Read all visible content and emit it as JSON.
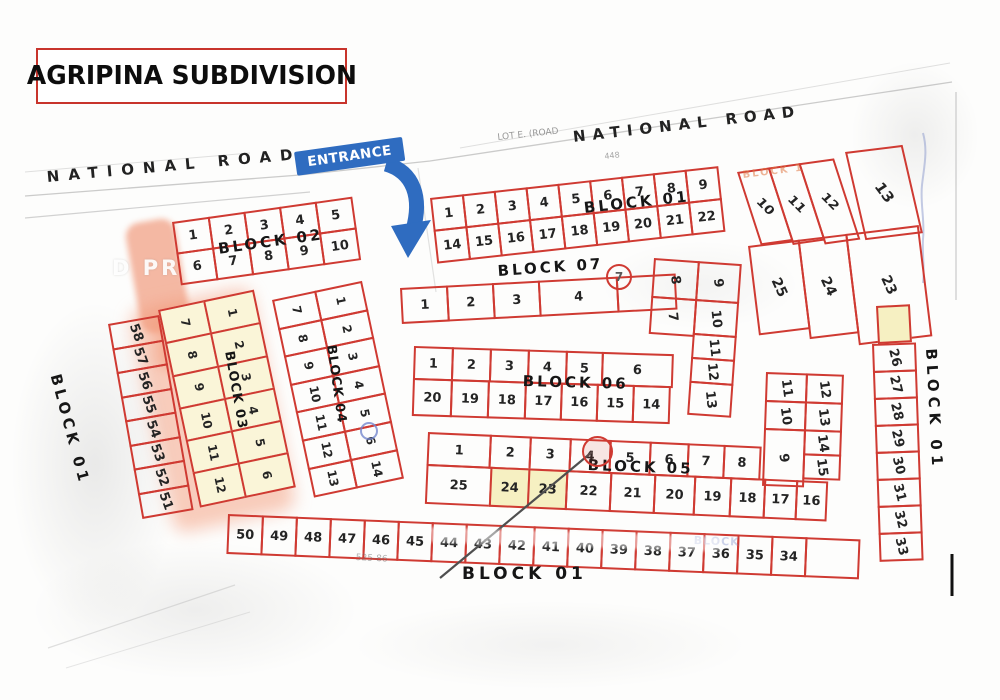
{
  "title": "AGRIPINA SUBDIVISION",
  "roads": {
    "left_label": "NATIONAL ROAD",
    "right_label": "NATIONAL ROAD"
  },
  "entrance": {
    "label": "ENTRANCE"
  },
  "colors": {
    "lot_border_red": "#cf3a32",
    "entrance_blue": "#2f6cc0",
    "highlight_yellow": "#f6f0c2",
    "block03_fill": "#faf5d8",
    "highlight_salmon": "#f2a286"
  },
  "labels": {
    "block01_top": "BLOCK 01",
    "block02": "BLOCK 02",
    "block03": "BLOCK 03",
    "block04": "BLOCK 04",
    "block05": "BLOCK 05",
    "block06": "BLOCK 06",
    "block07": "BLOCK 07",
    "block01_east": "BLOCK 01",
    "block01_west": "BLOCK 01",
    "block01_south": "BLOCK 01"
  },
  "lots": {
    "b01_top_r1": [
      "1",
      "2",
      "3",
      "4",
      "5",
      "6",
      "7",
      "8",
      "9"
    ],
    "b01_top_r2": [
      "14",
      "15",
      "16",
      "17",
      "18",
      "19",
      "20",
      "21",
      "22"
    ],
    "b01_slant": [
      "10",
      "11",
      "12"
    ],
    "b01_lot13": "13",
    "b01_cols": [
      "25",
      "24",
      "23"
    ],
    "b01_east": [
      "26",
      "27",
      "28",
      "29",
      "30",
      "31",
      "32",
      "33"
    ],
    "b01_west": [
      "58",
      "57",
      "56",
      "55",
      "54",
      "53",
      "52",
      "51"
    ],
    "b01_south": [
      "50",
      "49",
      "48",
      "47",
      "46",
      "45",
      "44",
      "43",
      "42",
      "41",
      "40",
      "39",
      "38",
      "37",
      "36",
      "35",
      "34"
    ],
    "b02_r1": [
      "1",
      "2",
      "3",
      "4",
      "5"
    ],
    "b02_r2": [
      "6",
      "7",
      "8",
      "9",
      "10"
    ],
    "b03_left": [
      "7",
      "8",
      "9",
      "10",
      "11",
      "12"
    ],
    "b03_right": [
      "1",
      "2",
      "3",
      "4",
      "5",
      "6"
    ],
    "b04_left": [
      "7",
      "8",
      "9",
      "10",
      "11",
      "12",
      "13"
    ],
    "b04_right": [
      "1",
      "2",
      "3",
      "4",
      "5",
      "6",
      "14"
    ],
    "b05_top": [
      "1",
      "2",
      "3",
      "4",
      "5",
      "6",
      "7",
      "8"
    ],
    "b05_ne_left": [
      "11",
      "10",
      "9"
    ],
    "b05_ne_right": [
      "12",
      "13",
      "14",
      "15"
    ],
    "b05_bottom": [
      "25",
      "24",
      "23",
      "22",
      "21",
      "20",
      "19",
      "18",
      "17",
      "16"
    ],
    "b06_top": [
      "1",
      "2",
      "3",
      "4",
      "5",
      "6"
    ],
    "b06_bottom": [
      "20",
      "19",
      "18",
      "17",
      "16",
      "15",
      "14"
    ],
    "b06_ne_left": [
      "8",
      "7"
    ],
    "b06_ne_right": [
      "9",
      "10",
      "11",
      "12",
      "13"
    ],
    "b07_row": [
      "1",
      "2",
      "3",
      "4"
    ]
  },
  "highlights": {
    "block05_yellow_lots": [
      "24",
      "23"
    ],
    "block05_circled_lot": "4",
    "block07_circled_number": "7"
  },
  "annotations": {
    "circled_seven": "7",
    "watermark_fragment": "D PR",
    "ghost_orange": "BLOCK 1",
    "ghost_blue": "BLOCK",
    "frag_lot_e": "LOT E. (ROAD",
    "frag_448": "448",
    "frag_bottom": "525-86"
  }
}
